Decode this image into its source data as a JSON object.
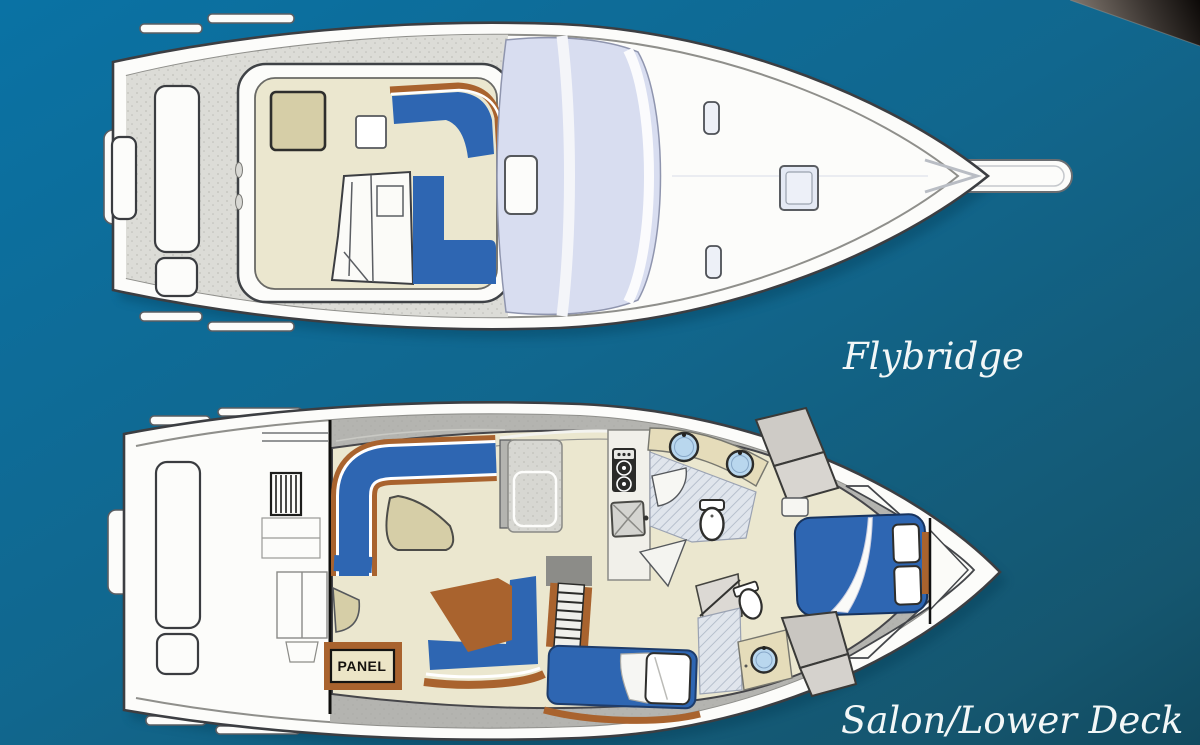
{
  "canvas": {
    "width": 1200,
    "height": 745
  },
  "labels": {
    "flybridge": "Flybridge",
    "lower_deck": "Salon/Lower Deck",
    "panel": "PANEL"
  },
  "colors": {
    "bg-top": "#0a72a4",
    "bg-mid": "#11678e",
    "bg-bottom": "#15566f",
    "bg-deep": "#114a5f",
    "corner-light": "#7b726a",
    "corner-dark": "#0d0a08",
    "hull-white": "#fcfcfa",
    "line-dark": "#3c3e42",
    "deck-gray": "#dcdcd7",
    "wall-gray": "#b4b4b0",
    "floor-beige": "#ebe7cf",
    "table-tan": "#d6cea7",
    "upholstery-blue": "#2e66b2",
    "trim-brown": "#a9632e",
    "window-lavender": "#d8ddf0",
    "counter-gray": "#d7d7d2",
    "sink-blue": "#b9d7ee",
    "stove-dark": "#2b2b29",
    "label-white": "#f2f7f7",
    "panel-bg": "#ece5c6",
    "panel-text": "#16130f",
    "shadow-navy": "#06364e"
  }
}
